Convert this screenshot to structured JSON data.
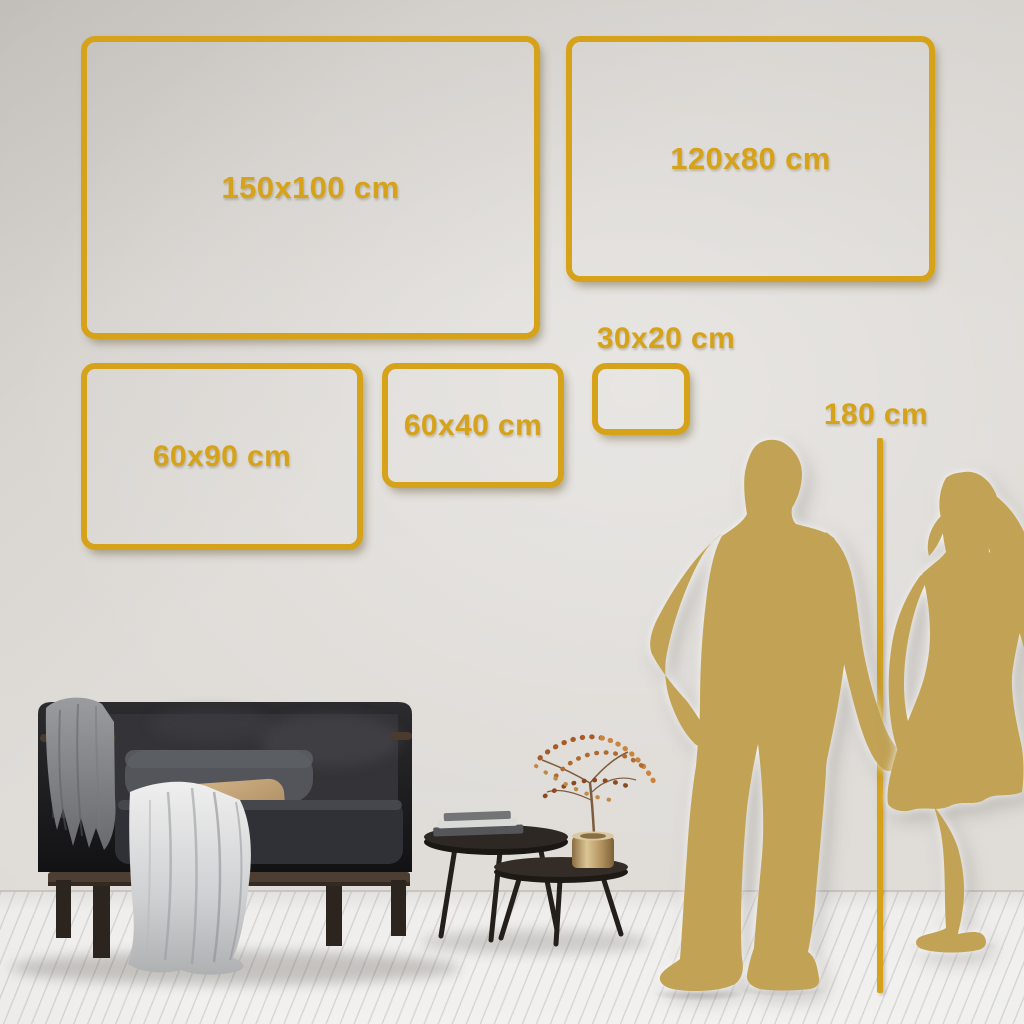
{
  "poster": {
    "frames": [
      {
        "label": "150x100 cm"
      },
      {
        "label": "120x80 cm"
      },
      {
        "label": "60x90 cm"
      },
      {
        "label": "60x40 cm"
      },
      {
        "label": "30x20 cm"
      }
    ],
    "height_reference_label": "180 cm"
  },
  "colors": {
    "accent_gold": "#d5a21a",
    "silhouette_gold": "#c2a355",
    "wall": "#dcd9d5",
    "floor": "#f1f0ee"
  }
}
